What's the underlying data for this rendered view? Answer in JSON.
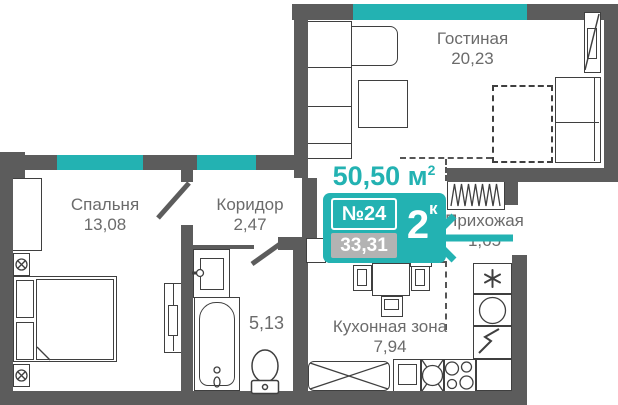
{
  "apartment": {
    "total_area": "50,50",
    "total_area_unit": " м",
    "total_area_sup": "2",
    "number": "№24",
    "sellable_area": "33,31",
    "rooms_count": "2",
    "rooms_count_suffix": "к"
  },
  "rooms": {
    "living": {
      "name": "Гостиная",
      "area": "20,23"
    },
    "bedroom": {
      "name": "Спальня",
      "area": "13,08"
    },
    "corridor": {
      "name": "Коридор",
      "area": "2,47"
    },
    "hallway": {
      "name": "Прихожая",
      "area": "1,65"
    },
    "kitchen": {
      "name": "Кухонная зона",
      "area": "7,94"
    },
    "bathroom": {
      "area": "5,13"
    }
  },
  "icons": {
    "entrance_arrow": "arrow-left",
    "freezer": "snowflake-asterisk",
    "washing_machine": "circle",
    "water_heater": "zigzag",
    "wardrobe": "hanger-zigzag-hatch"
  },
  "colors": {
    "wall": "#5c5c5c",
    "accent": "#23b2b2",
    "badge-gray": "#b3b3b3",
    "label": "#6b6b6b",
    "line": "#3f3f3f"
  }
}
